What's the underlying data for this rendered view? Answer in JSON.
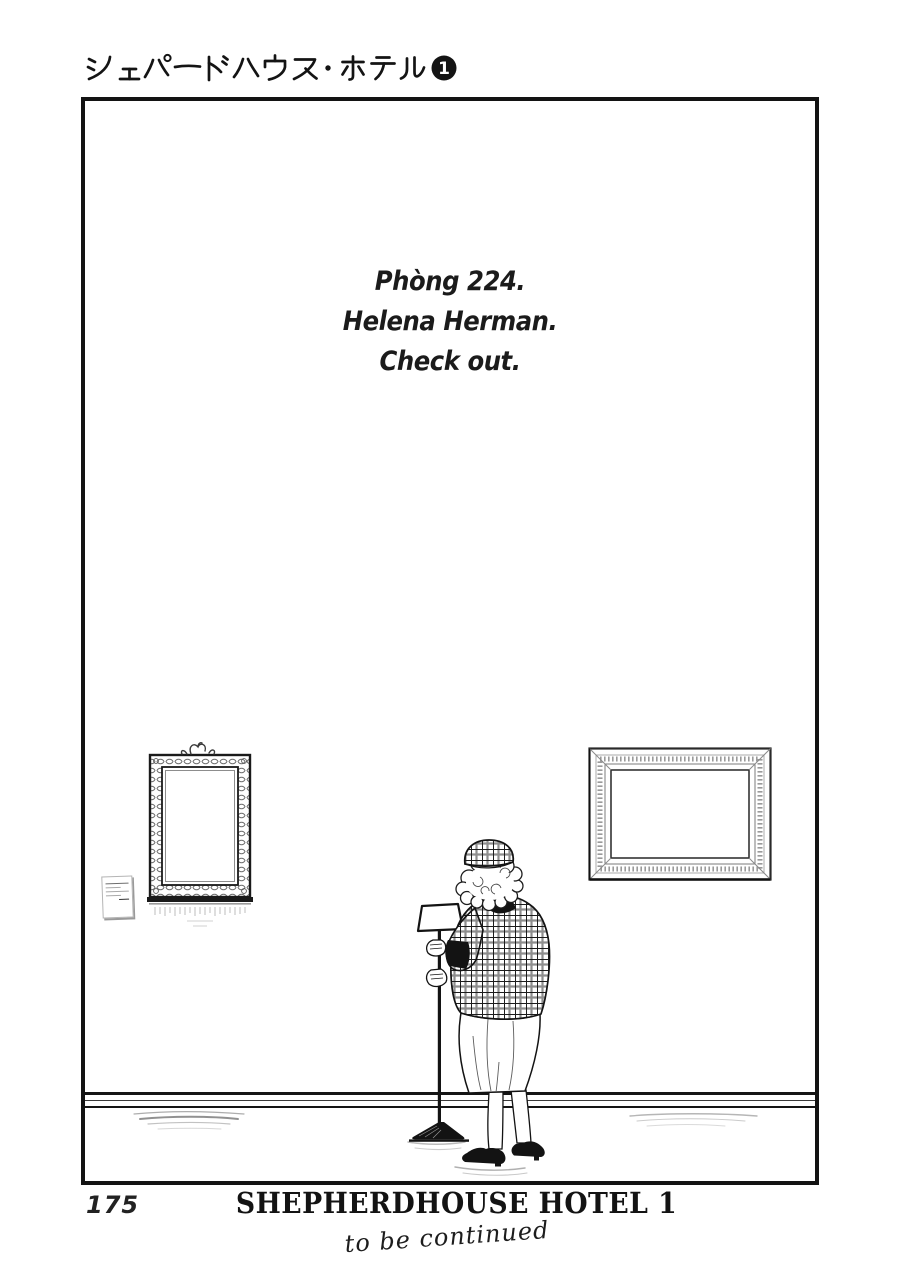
{
  "header": {
    "title": "シェパードハウス・ホテル",
    "volume_number": "1"
  },
  "dialogue": {
    "lines": [
      "Phòng 224.",
      "Helena Herman.",
      "Check out."
    ]
  },
  "footer": {
    "page_number": "175",
    "series_title": "SHEPHERDHOUSE HOTEL 1",
    "continued_note": "to be continued"
  },
  "colors": {
    "ink": "#151515",
    "paper": "#ffffff",
    "engraving_gray": "#888888"
  }
}
